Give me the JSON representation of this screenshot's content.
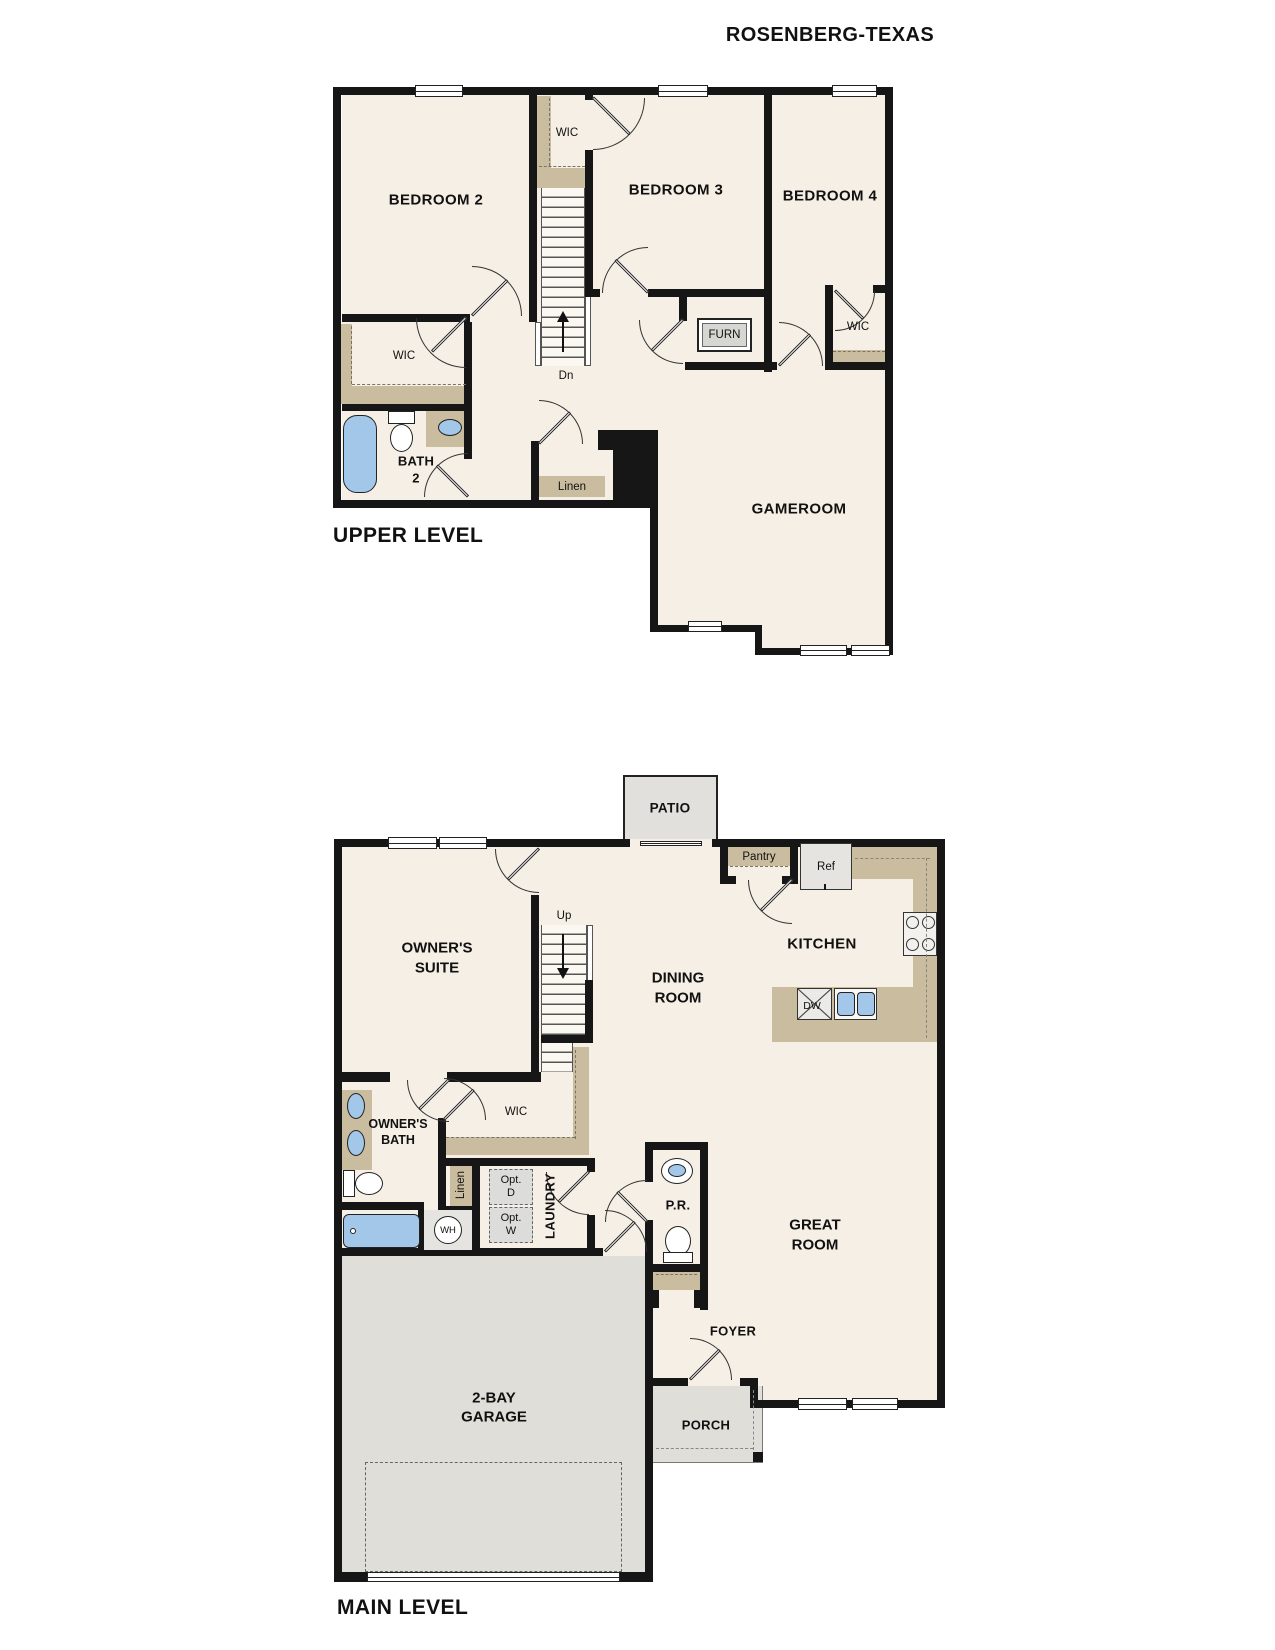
{
  "title": "ROSENBERG-TEXAS",
  "upper_level": {
    "caption": "UPPER LEVEL",
    "bedroom2": "BEDROOM 2",
    "bedroom3": "BEDROOM 3",
    "bedroom4": "BEDROOM 4",
    "gameroom": "GAMEROOM",
    "wic_bedroom3": "WIC",
    "wic_bedroom2": "WIC",
    "wic_bedroom4": "WIC",
    "furnace": "FURN",
    "bath_line1": "BATH",
    "bath_line2": "2",
    "linen": "Linen",
    "stairs_down": "Dn"
  },
  "main_level": {
    "caption": "MAIN LEVEL",
    "patio": "PATIO",
    "owners_suite_line1": "OWNER'S",
    "owners_suite_line2": "SUITE",
    "dining_line1": "DINING",
    "dining_line2": "ROOM",
    "kitchen": "KITCHEN",
    "pantry": "Pantry",
    "fridge": "Ref",
    "dishwasher": "DW",
    "stairs_up": "Up",
    "wic": "WIC",
    "owners_bath_line1": "OWNER'S",
    "owners_bath_line2": "BATH",
    "linen": "Linen",
    "opt_dryer_line1": "Opt.",
    "opt_dryer_line2": "D",
    "opt_washer_line1": "Opt.",
    "opt_washer_line2": "W",
    "laundry": "LAUNDRY",
    "water_heater": "WH",
    "powder_room": "P.R.",
    "great_room_line1": "GREAT",
    "great_room_line2": "ROOM",
    "garage_line1": "2-BAY",
    "garage_line2": "GARAGE",
    "foyer": "FOYER",
    "porch": "PORCH"
  },
  "colors": {
    "floor": "#f6efe5",
    "wall": "#161616",
    "cabinet_tan": "#cabd9f",
    "exterior_gray": "#e0ded9",
    "fixture_blue": "#a3c7e8"
  }
}
